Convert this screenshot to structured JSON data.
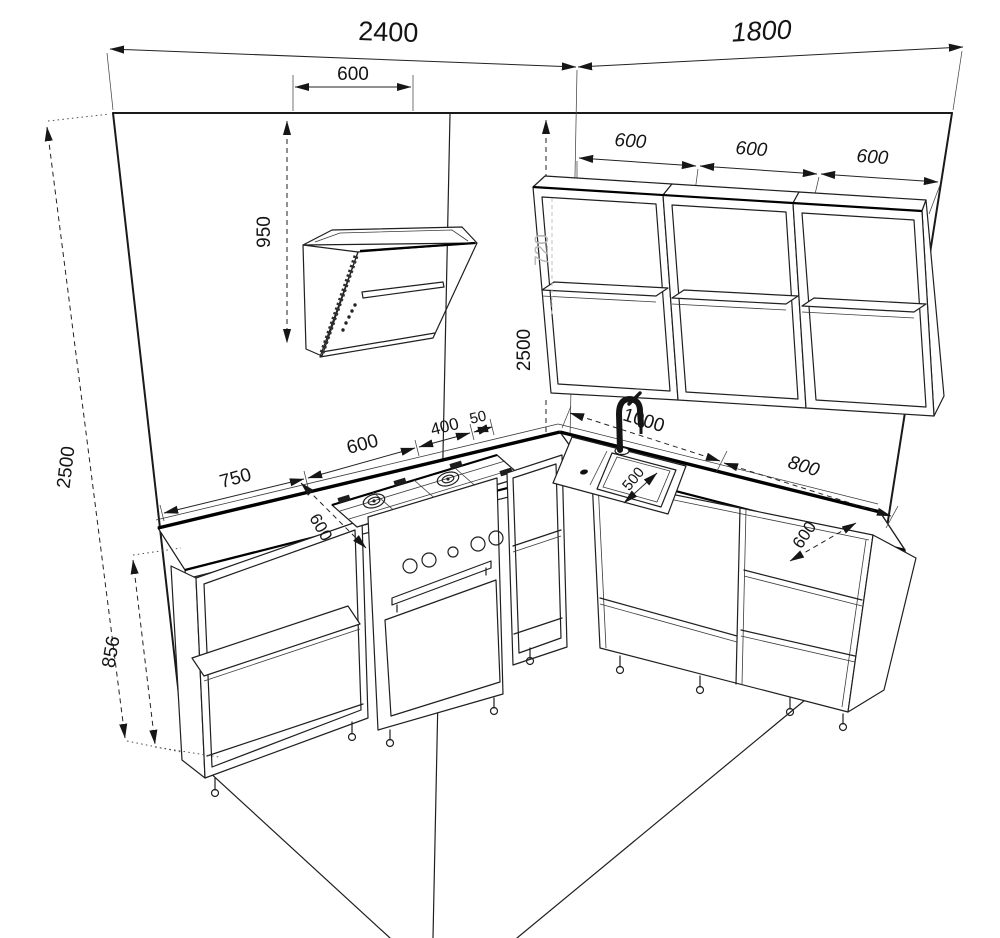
{
  "dims": {
    "left_wall_width": "2400",
    "right_wall_width": "1800",
    "hood_width": "600",
    "hood_to_ceiling": "950",
    "wall_height_left": "2500",
    "wall_height_corner": "2500",
    "wall_cabinet_height": "720",
    "wall_cab_1": "600",
    "wall_cab_2": "600",
    "wall_cab_3": "600",
    "base_left": "750",
    "cooktop": "600",
    "corner_400": "400",
    "corner_50": "50",
    "depth_left": "600",
    "sink_run": "1000",
    "right_run": "800",
    "depth_right": "600",
    "sink_width": "500",
    "base_height": "856"
  }
}
